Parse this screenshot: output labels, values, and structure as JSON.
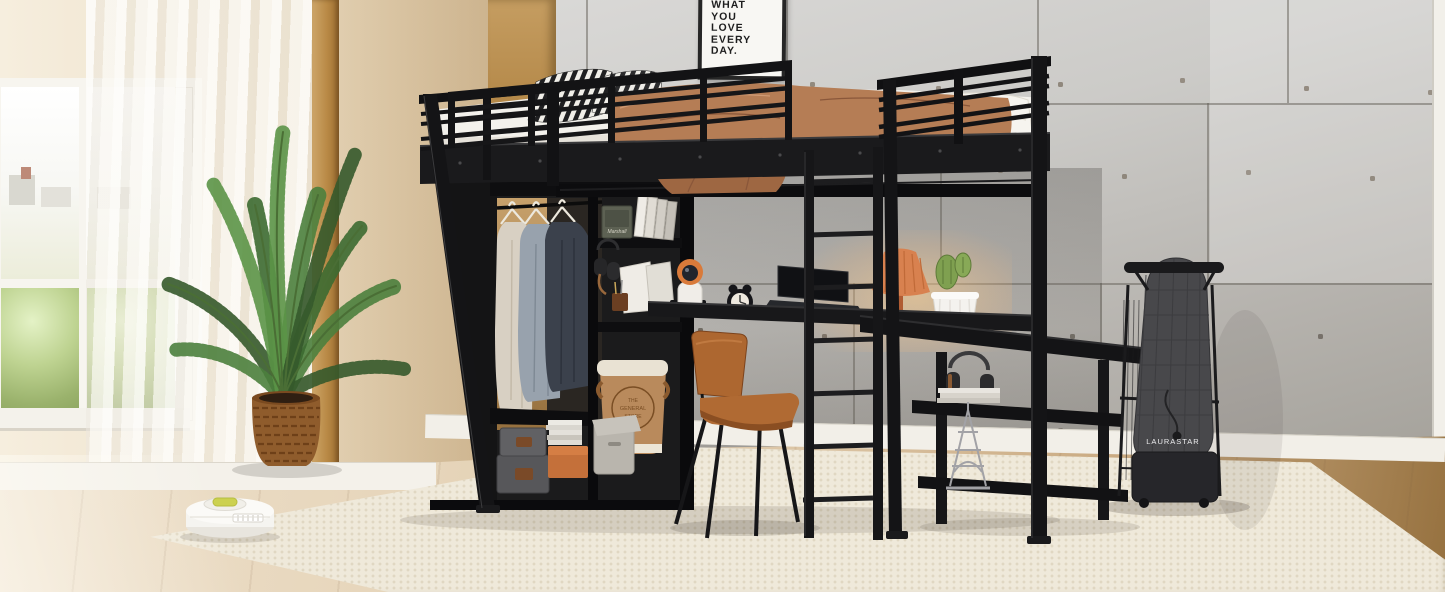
{
  "meta": {
    "type": "product-photo",
    "subject": "Black metal loft bed with wardrobe, shelves and built-in desk",
    "room": "bedroom with concrete accent wall, window and rug"
  },
  "poster": {
    "lines": [
      "WHAT",
      "YOU",
      "LOVE",
      "EVERY",
      "DAY."
    ]
  },
  "wardrobe": {
    "speaker_brand": "Marshall"
  },
  "basket": {
    "stamp_lines": [
      "THE",
      "GENERAL",
      "STORE"
    ]
  },
  "ironing_board": {
    "brand": "LAURASTAR"
  },
  "palette": {
    "bed_metal": "#17171a",
    "blanket": "#b57d55",
    "chair_leather": "#ad6730",
    "wall_concrete": "#c8c7c5",
    "wall_beige": "#e9dcc8",
    "floor_wood": "#d9c3a4",
    "rug": "#efe9db",
    "plant_green": "#4a7c3c",
    "lamp_shade": "#d8814f",
    "vacuum_accent": "#c9d14e"
  }
}
